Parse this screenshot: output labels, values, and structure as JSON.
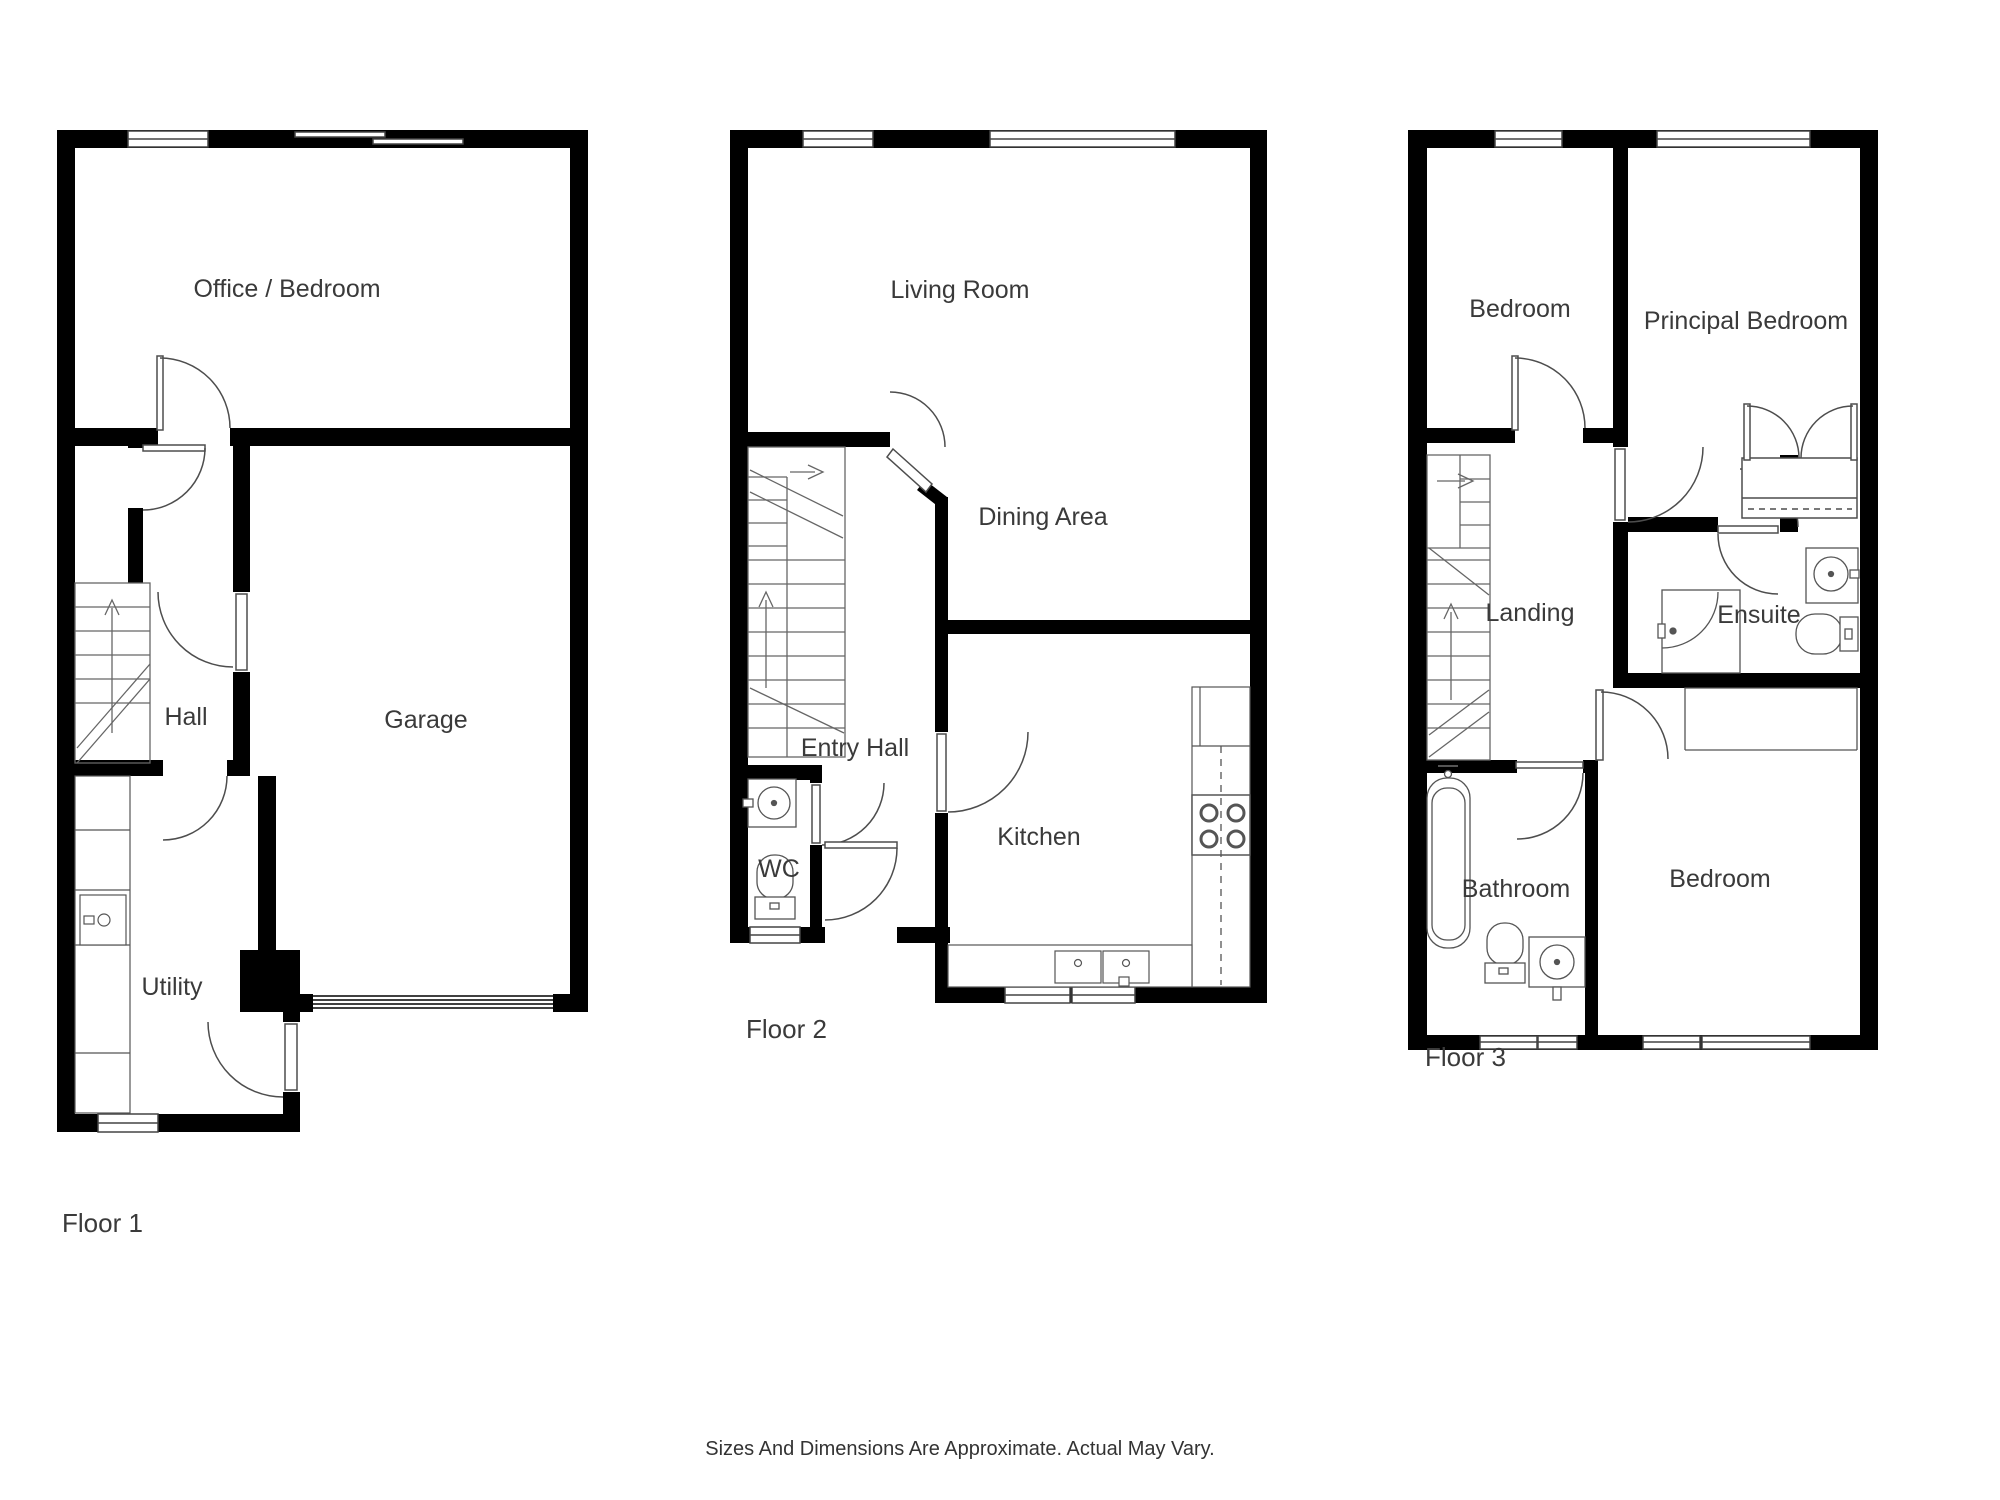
{
  "page": {
    "background": "#ffffff",
    "wall_color": "#000000",
    "line_color": "#4d4d4d",
    "text_color": "#3a3a3a"
  },
  "floor1": {
    "label": "Floor 1",
    "rooms": {
      "office": "Office / Bedroom",
      "hall": "Hall",
      "garage": "Garage",
      "utility": "Utility"
    }
  },
  "floor2": {
    "label": "Floor 2",
    "rooms": {
      "living": "Living Room",
      "dining": "Dining Area",
      "entry": "Entry Hall",
      "wc": "WC",
      "kitchen": "Kitchen"
    }
  },
  "floor3": {
    "label": "Floor 3",
    "rooms": {
      "bedroom_top": "Bedroom",
      "principal": "Principal Bedroom",
      "landing": "Landing",
      "ensuite": "Ensuite",
      "bathroom": "Bathroom",
      "bedroom_bottom": "Bedroom"
    }
  },
  "footer": {
    "disclaimer": "Sizes And Dimensions Are Approximate. Actual May Vary."
  }
}
